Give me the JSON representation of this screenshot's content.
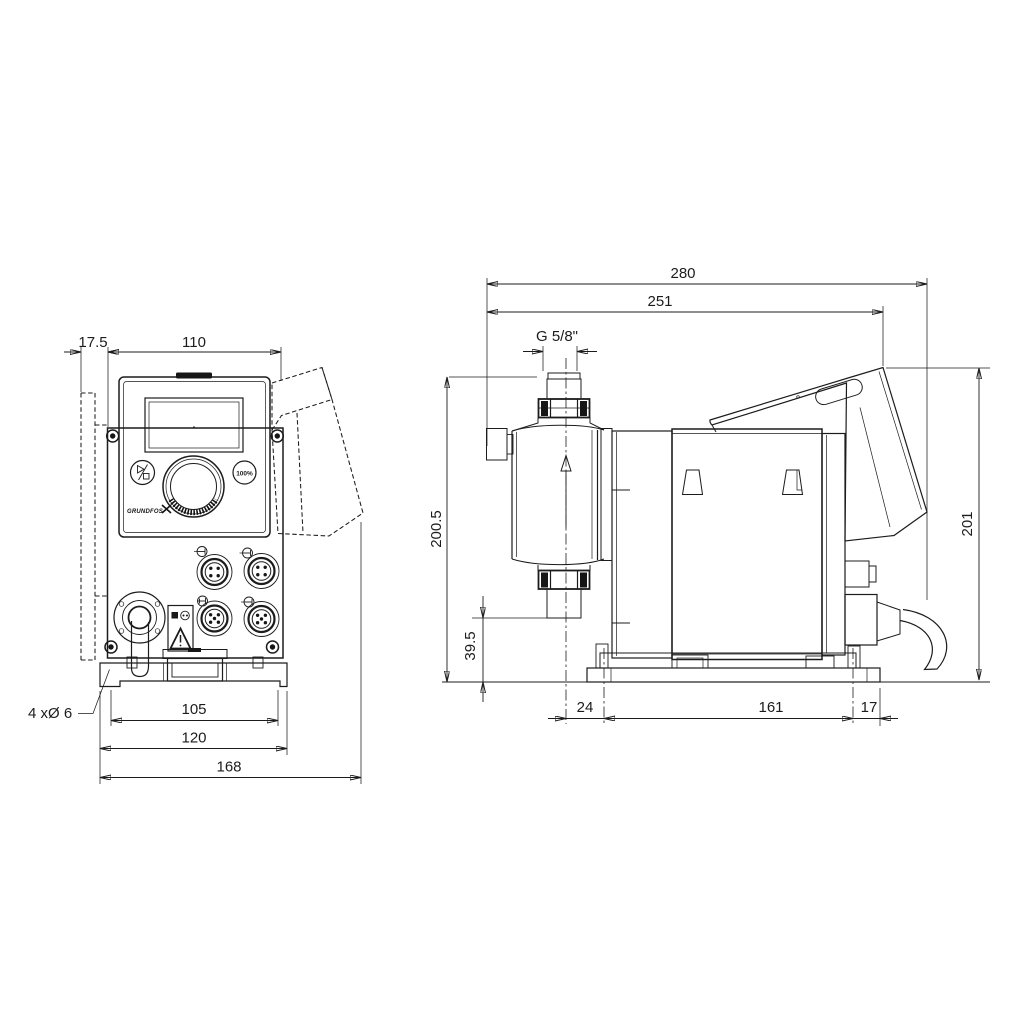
{
  "colors": {
    "line": "#1c1c1c",
    "background": "#ffffff",
    "dark_fill": "#161616"
  },
  "front_view": {
    "dims": {
      "wall_offset": "17.5",
      "housing_width": "110",
      "hole_spacing": "105",
      "plate_width": "120",
      "overall_width": "168"
    },
    "mounting_holes_label": "4 xØ 6",
    "controls": {
      "button_100": "100%",
      "logo": "GRUNDFOS"
    }
  },
  "side_view": {
    "dims": {
      "overall_depth": "280",
      "depth_to_hood": "251",
      "thread": "G 5/8\"",
      "height_overall": "200.5",
      "connector_height": "39.5",
      "hood_height": "201",
      "base_front": "24",
      "hole_spacing": "161",
      "base_rear": "17"
    }
  }
}
